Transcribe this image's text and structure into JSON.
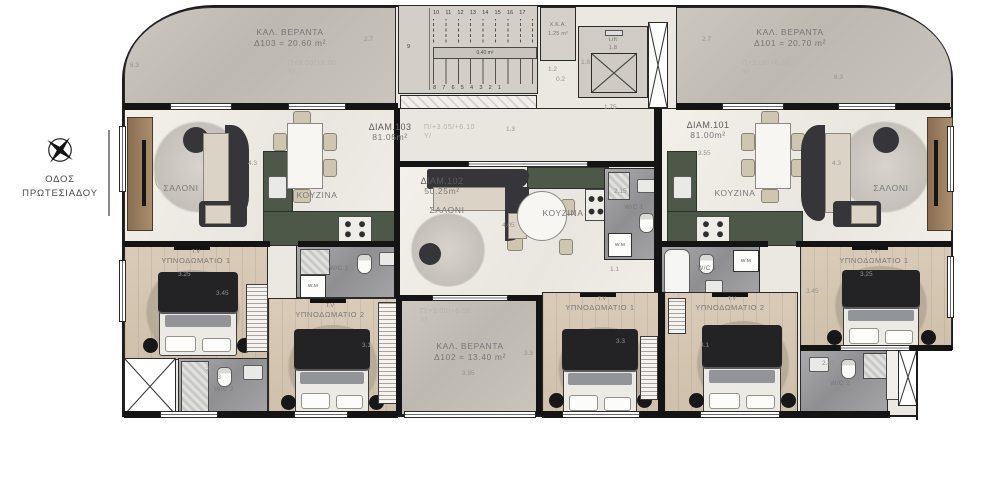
{
  "street": {
    "line1": "ΟΔΟΣ",
    "line2": "ΠΡΩΤΕΣΙΑΔΟΥ"
  },
  "balcony_left": {
    "title": "ΚΑΛ. ΒΕΡΑΝΤΑ",
    "area": "Δ103 = 20.60 m²",
    "level": "Π+3.00/+8.00",
    "axis": "Y/",
    "dim_w": "8.3",
    "dim_h": "2.7"
  },
  "balcony_right": {
    "title": "ΚΑΛ. ΒΕΡΑΝΤΑ",
    "area": "Δ101 = 20.70 m²",
    "level": "Π+3.00/+6.00",
    "axis": "Y/",
    "dim_w": "8.3",
    "dim_h": "2.7"
  },
  "balcony_mid": {
    "title": "ΚΑΛ. ΒΕΡΑΝΤΑ",
    "area": "Δ102 = 13.40 m²",
    "level": "Π/+3.00/+6.00",
    "axis": "Y/",
    "dim_w": "3.95",
    "dim_h": "3.3"
  },
  "corridor": {
    "level": "Π/+3.05/+6.10",
    "axis": "Y/",
    "dim": "1.3"
  },
  "core": {
    "steps_top": "10 11 12 13 14 15 16 17",
    "steps_bottom": "8 7 6 5 4 3 2 1",
    "step_side": "9",
    "stair_area": "0.40 m²",
    "xka_title": "X.K.A.",
    "xka_area": "1.25 m²",
    "lift_title": "Lift",
    "lift_dim": "1.8",
    "lift_dim_side": "1.8",
    "dim_a": "1.2",
    "dim_b": "0.2",
    "dim_c": "1.75"
  },
  "apt_left": {
    "id": "ΔΙΑΜ.103",
    "area": "81.05m²",
    "salon": "ΣΑΛΟΝΙ",
    "kitchen": "ΚΟΥΖΙΝΑ",
    "wc1": "W/C 1",
    "wc2": "W/C 2",
    "wm": "W.M",
    "salon_dim": "4.3",
    "bed1_tv": "T.V",
    "bed1": "ΥΠΝΟΔΩΜΑΤΙΟ 1",
    "bed1_dim_w": "3.25",
    "bed1_dim_h": "3.45",
    "bed2_tv": "T.V",
    "bed2": "ΥΠΝΟΔΩΜΑΤΙΟ 2",
    "bed2_dim": "3.1",
    "wc2_dim_a": "2.85",
    "wc2_dim_b": "1.3"
  },
  "apt_mid": {
    "id": "ΔΙΑΜ.102",
    "area": "50.25m²",
    "salon": "ΣΑΛΟΝΙ",
    "kitchen": "ΚΟΥΖΙΝΑ",
    "wc1": "W/C 1",
    "wm": "W.M",
    "wc1_dim": "2.15",
    "hall_dim": "1.1",
    "salon_dim": "4.05",
    "bed1_tv": "T.V",
    "bed1": "ΥΠΝΟΔΩΜΑΤΙΟ 1",
    "bed1_dim": "3.3"
  },
  "apt_right": {
    "id": "ΔΙΑΜ.101",
    "area": "81.00m²",
    "salon": "ΣΑΛΟΝΙ",
    "kitchen": "ΚΟΥΖΙΝΑ",
    "wc1": "W/C 1",
    "wc2": "W/C 2",
    "wm": "W.M",
    "salon_dim": "4.3",
    "kitchen_dim": "3.55",
    "bed1_tv": "T.V",
    "bed1": "ΥΠΝΟΔΩΜΑΤΙΟ 1",
    "bed1_dim_w": "3.25",
    "bed1_dim_h": "3.45",
    "bed2_tv": "T.V",
    "bed2": "ΥΠΝΟΔΩΜΑΤΙΟ 2",
    "bed2_dim": "3.1",
    "wc2_dim_a": "2.85",
    "wc2_dim_b": "1.3"
  },
  "colors": {
    "wall": "#1c1c1c",
    "kitchen_counter": "#4d5848",
    "stone_floor": "#c7c2ba",
    "wood_floor": "#d7c9b6",
    "bath_floor": "#a3a3a6",
    "furniture_dark": "#35353a",
    "furniture_beige": "#dbd4c6"
  }
}
